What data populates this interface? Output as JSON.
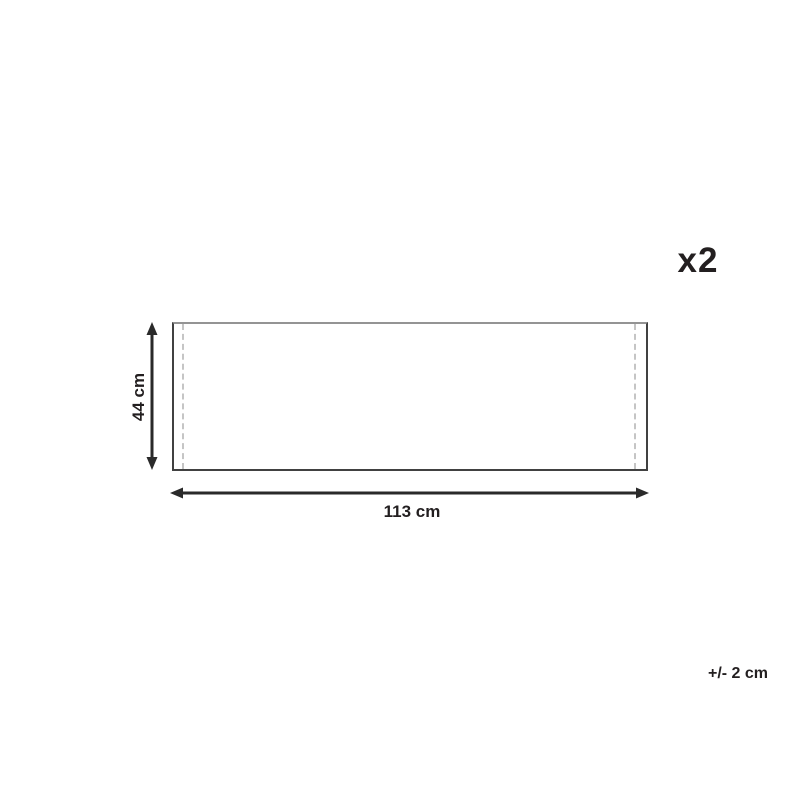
{
  "diagram": {
    "type": "product-dimension-diagram",
    "quantity": {
      "label": "x2"
    },
    "height_dimension": {
      "label": "44 cm",
      "value_cm": 44
    },
    "width_dimension": {
      "label": "113 cm",
      "value_cm": 113
    },
    "tolerance": {
      "label": "+/- 2 cm",
      "value_cm": 2
    },
    "colors": {
      "arrow": "#2a2a2a",
      "text": "#231f20",
      "outline_side": "#414141",
      "outline_top": "#949494",
      "seam_dashed": "#c5c5c5",
      "background": "#ffffff"
    }
  }
}
